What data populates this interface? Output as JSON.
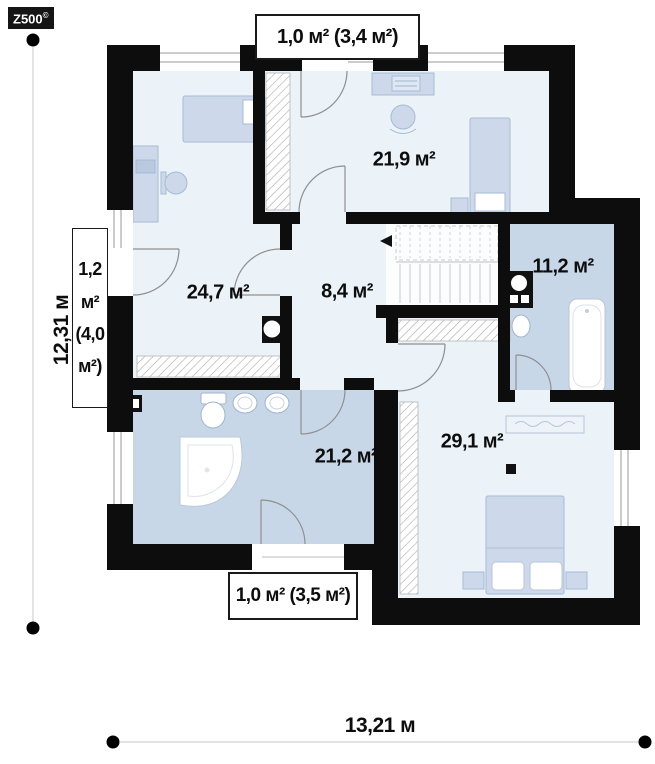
{
  "logo": {
    "brand": "Z500",
    "mark": "©"
  },
  "floorplan": {
    "rooms": [
      {
        "id": "bedroom-top-right",
        "area": "21,9 м²"
      },
      {
        "id": "bedroom-left",
        "area": "24,7 м²"
      },
      {
        "id": "hall",
        "area": "8,4 м²"
      },
      {
        "id": "bathroom-right",
        "area": "11,2 м²"
      },
      {
        "id": "bathroom-left",
        "area": "21,2 м²"
      },
      {
        "id": "bedroom-bottom-right",
        "area": "29,1 м²"
      }
    ],
    "balconies": {
      "top": "1,0 м² (3,4 м²)",
      "bottom": "1,0 м² (3,5 м²)",
      "left_lines": [
        "1,2",
        "м²",
        "(4,0",
        "м²)"
      ]
    },
    "dimensions": {
      "total_height": "12,31 м",
      "total_width": "13,21 м"
    }
  },
  "colors": {
    "wall": "#0d0d0d",
    "floor": "#ebf2f8",
    "bathroom_floor": "#c8d7e8",
    "furniture_fill": "#cdd9eb",
    "furniture_stroke": "#a6bad4"
  }
}
